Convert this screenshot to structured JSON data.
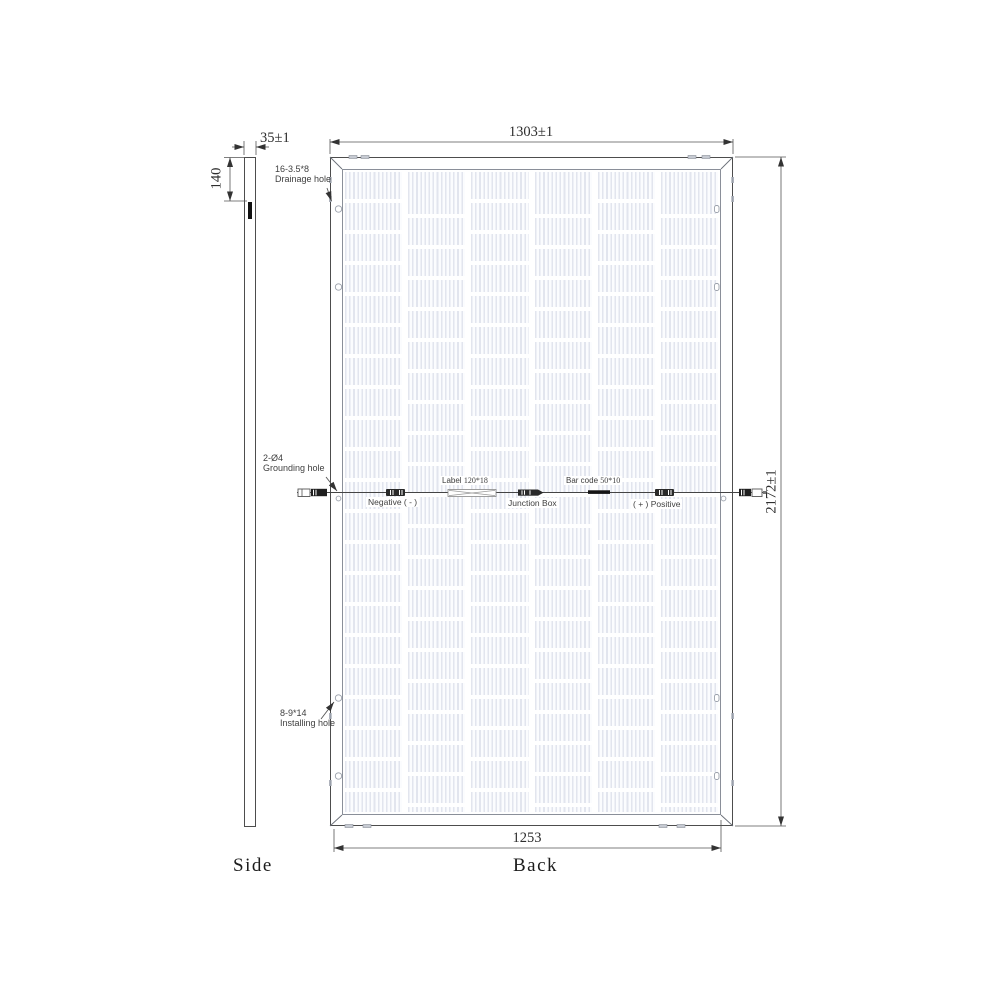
{
  "drawing": {
    "side_view": {
      "title": "Side",
      "thickness_dim": "35±1",
      "bracket_dim": "140"
    },
    "back_view": {
      "title": "Back",
      "width_dim": "1303±1",
      "height_dim": "2172±1",
      "bottom_width_dim": "1253",
      "callouts": {
        "drainage": {
          "spec": "16-3.5*8",
          "label": "Drainage hole"
        },
        "grounding": {
          "spec": "2-Ø4",
          "label": "Grounding hole"
        },
        "installing": {
          "spec": "8-9*14",
          "label": "Installing hole"
        }
      },
      "cable": {
        "label_tag": {
          "name": "Label",
          "size": "120*18"
        },
        "barcode_tag": {
          "name": "Bar code",
          "size": "50*10"
        },
        "negative": "Negative ( - )",
        "junction_box": "Junction Box",
        "positive": "( + ) Positive"
      }
    },
    "colors": {
      "line": "#4d4d4d",
      "frame_inner_line": "#8a8f99",
      "cell_stripe": "#e2e5ee",
      "text": "#3a3a3a"
    }
  }
}
